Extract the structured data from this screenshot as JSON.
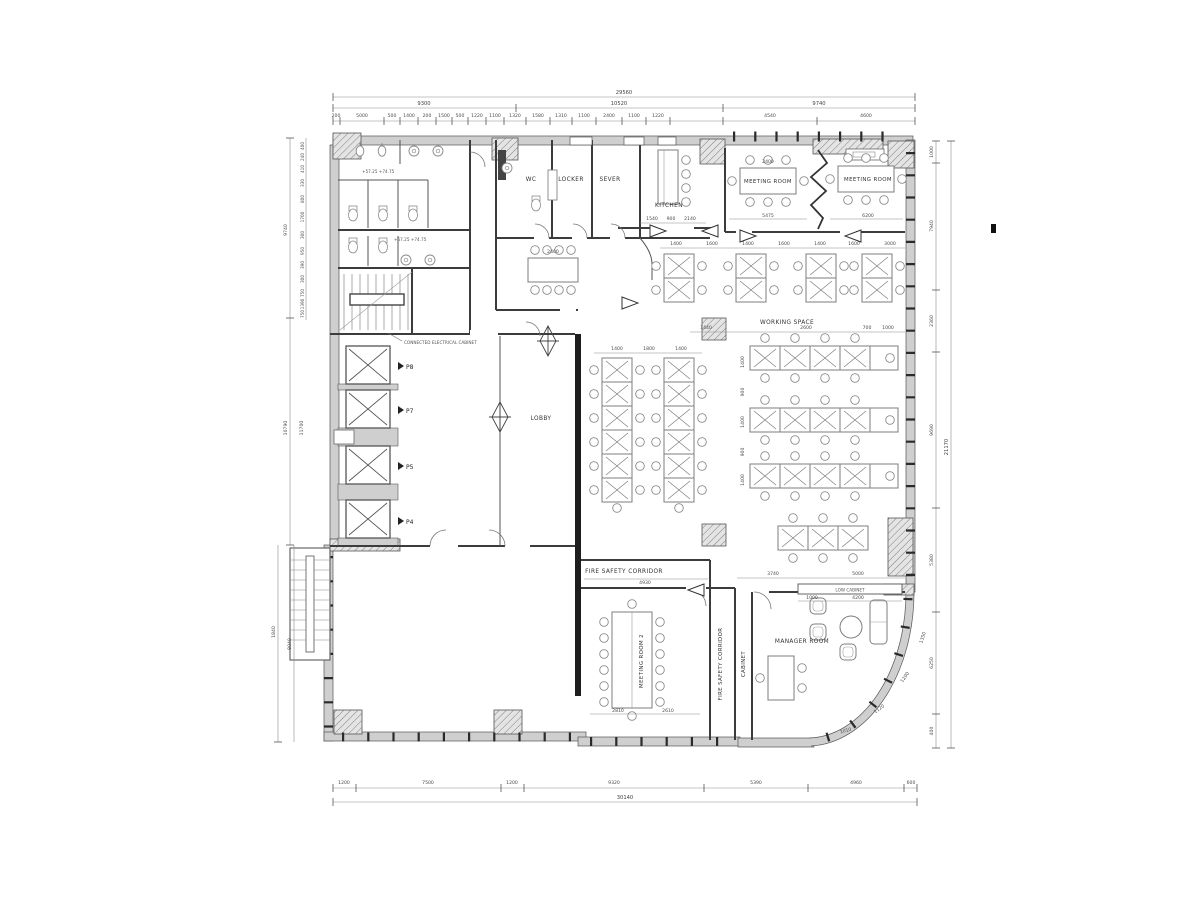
{
  "rooms": {
    "wc": "WC",
    "locker": "LOCKER",
    "sever": "SEVER",
    "kitchen": "KITCHEN",
    "meeting_room_a": "MEETING ROOM",
    "meeting_room_b": "MEETING ROOM",
    "working_space": "WORKING SPACE",
    "lobby": "LOBBY",
    "fire_corridor_h": "FIRE SAFETY CORRIDOR",
    "fire_corridor_v": "FIRE SAFETY CORRIDOR",
    "meeting_room_2": "MEETING ROOM 2",
    "cabinet": "CABINET",
    "manager_room": "MANAGER ROOM",
    "low_cabinet": "LOW CABINET"
  },
  "labels": {
    "electrical_cabinet": "CONNECTED ELECTRICAL CABINET",
    "elevation_note": "+57.25  +74.75"
  },
  "elevators": [
    "P8",
    "P7",
    "P5",
    "P4"
  ],
  "dims": {
    "top_total": "29560",
    "top_main": [
      "9300",
      "10520",
      "9740"
    ],
    "top_detail": [
      "200",
      "5000",
      "500",
      "1400",
      "200",
      "1500",
      "500",
      "1220",
      "1100",
      "1320",
      "1580",
      "1310",
      "1100",
      "2400",
      "1100",
      "1220",
      "4540",
      "4600"
    ],
    "bottom": [
      "1200",
      "7500",
      "1200",
      "9320",
      "5390",
      "4960",
      "600"
    ],
    "bottom_total": "30140",
    "right": [
      "1000",
      "7940",
      "2360",
      "9690",
      "5380",
      "6250",
      "400"
    ],
    "right_total": "21170",
    "left_main": [
      "9740",
      "10790",
      "11700",
      "1840",
      "8040"
    ],
    "left_detail": [
      "400",
      "240",
      "410",
      "330",
      "800",
      "1700",
      "300",
      "950",
      "390",
      "300",
      "750",
      "1390",
      "750"
    ],
    "meeting_a": [
      "2400",
      "5475"
    ],
    "meeting_b": [
      "6200"
    ],
    "open_table": "2400",
    "ws_top": [
      "1400",
      "1600",
      "1400",
      "1600",
      "1400",
      "1600",
      "3000"
    ],
    "ws_mid": [
      "1440",
      "2600",
      "700",
      "1000"
    ],
    "desk_cols": [
      "1400",
      "1800",
      "1400"
    ],
    "ws_rows": [
      "1400",
      "900",
      "1400",
      "900",
      "1400"
    ],
    "south": [
      "4930",
      "3740",
      "5000"
    ],
    "low_cabinet": [
      "1000",
      "4200"
    ],
    "meeting2": [
      "2810",
      "2610"
    ],
    "entry": [
      "1540",
      "900",
      "2140"
    ],
    "curve": [
      "1350",
      "1200",
      "1120",
      "1010"
    ]
  }
}
